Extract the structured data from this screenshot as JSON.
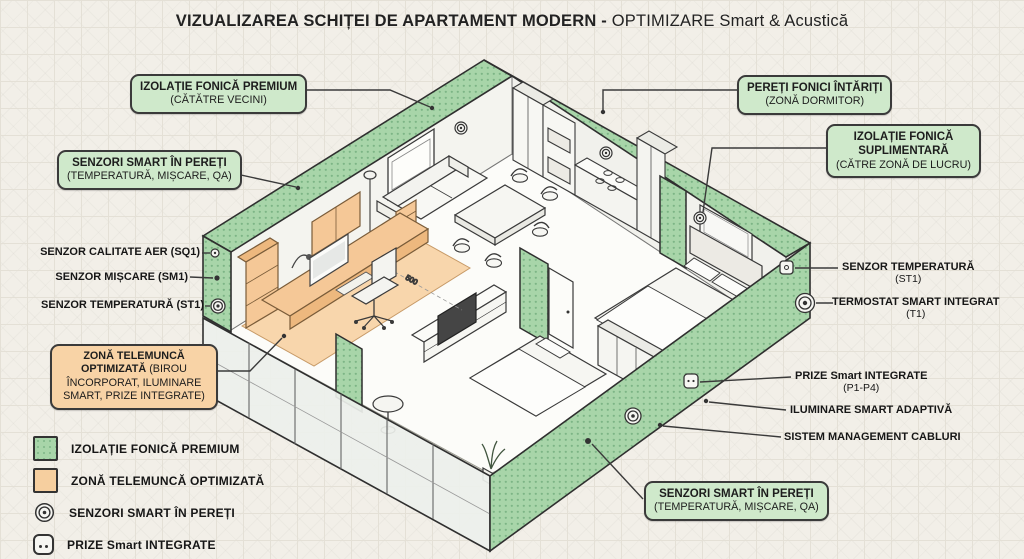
{
  "title": {
    "main": "VIZUALIZAREA SCHIȚEI DE APARTAMENT MODERN -",
    "accent": "OPTIMIZARE Smart & Acustică"
  },
  "callouts": {
    "premium": {
      "line1": "IZOLAȚIE FONICĂ PREMIUM",
      "line2": "(CĂTĂTRE VECINI)"
    },
    "pereti": {
      "line1": "PEREȚI FONICI ÎNTĂRIȚI",
      "line2": "(ZONĂ DORMITOR)"
    },
    "suplimentara": {
      "line1": "IZOLAȚIE FONICĂ",
      "line2": "SUPLIMENTARĂ",
      "line3": "(CĂTRE ZONĂ DE LUCRU)"
    },
    "senzori_left": {
      "line1": "SENZORI SMART ÎN PEREȚI",
      "line2": "(TEMPERATURĂ, MIȘCARE, QA)"
    },
    "telemunca": {
      "bold": "ZONĂ TELEMUNCĂ OPTIMIZATĂ",
      "rest": "(BIROU ÎNCORPORAT, ILUMINARE SMART, PRIZE INTEGRATE)"
    },
    "senzori_bottom": {
      "line1": "SENZORI SMART ÎN PEREȚI",
      "line2": "(TEMPERATURĂ, MIȘCARE, QA)"
    }
  },
  "sensor_labels": {
    "air_quality": "SENZOR CALITATE AER (SQ1)",
    "motion": "SENZOR MIȘCARE (SM1)",
    "temperature": "SENZOR TEMPERATURĂ (ST1)"
  },
  "right_labels": {
    "temp": {
      "line1": "SENZOR TEMPERATURĂ",
      "line2": "(ST1)"
    },
    "termostat": {
      "line1": "TERMOSTAT SMART INTEGRAT",
      "line2": "(T1)"
    },
    "prize": {
      "line1": "PRIZE Smart INTEGRATE",
      "line2": "(P1-P4)"
    },
    "iluminare": {
      "line1": "ILUMINARE SMART ADAPTIVĂ"
    },
    "cabluri": {
      "line1": "SISTEM MANAGEMENT CABLURI"
    }
  },
  "legend": {
    "items": [
      {
        "label": "IZOLAȚIE FONICĂ PREMIUM"
      },
      {
        "label": "ZONĂ TELEMUNCĂ OPTIMIZATĂ"
      },
      {
        "label": "SENZORI SMART ÎN PEREȚI"
      },
      {
        "label": "PRIZE Smart INTEGRATE"
      }
    ]
  },
  "floor_plan": {
    "dimension_label": "500"
  },
  "colors": {
    "wall_green": "#a8d5a9",
    "wall_dot": "#7db586",
    "callout_green": "#cfe9cb",
    "zone_orange": "#f8d6ac",
    "desk_orange": "#f5c897",
    "outline": "#2f2f2f",
    "background": "#f2efe8"
  }
}
